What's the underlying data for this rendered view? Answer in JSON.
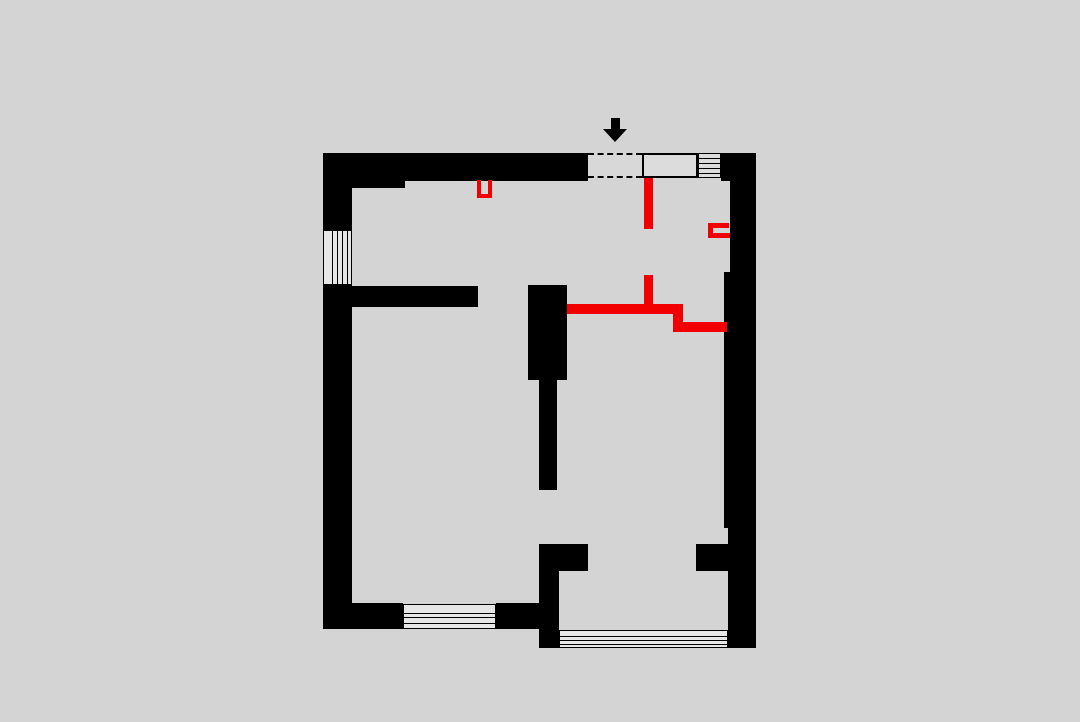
{
  "meta": {
    "description": "architectural floor plan drawing, black existing walls with red new partition walls, entry arrow at top",
    "canvas_w": 1080,
    "canvas_h": 722
  },
  "palette": {
    "bg": "#d4d4d4",
    "wall": "#000000",
    "new_wall": "#f20000",
    "fill_light": "#dcdcdc",
    "opening_fill": "#d8d8d8",
    "window_fill": "#e6e6e6"
  },
  "plan": {
    "shapes": [
      {
        "name": "top-wall-thick-left",
        "type": "wall",
        "x": 323,
        "y": 153,
        "w": 82,
        "h": 35
      },
      {
        "name": "top-wall",
        "type": "wall",
        "x": 405,
        "y": 153,
        "w": 183,
        "h": 28
      },
      {
        "name": "left-wall-upper",
        "type": "wall",
        "x": 323,
        "y": 153,
        "w": 29,
        "h": 77
      },
      {
        "name": "left-wall-lower",
        "type": "wall",
        "x": 323,
        "y": 285,
        "w": 29,
        "h": 344
      },
      {
        "name": "top-right-corner-wall",
        "type": "wall",
        "x": 721,
        "y": 153,
        "w": 35,
        "h": 28
      },
      {
        "name": "right-wall-upper",
        "type": "wall",
        "x": 730,
        "y": 181,
        "w": 26,
        "h": 91
      },
      {
        "name": "right-wall-mid",
        "type": "wall",
        "x": 724,
        "y": 272,
        "w": 32,
        "h": 256
      },
      {
        "name": "right-wall-lower",
        "type": "wall",
        "x": 728,
        "y": 528,
        "w": 28,
        "h": 120
      },
      {
        "name": "hallway-wall",
        "type": "wall",
        "x": 352,
        "y": 286,
        "w": 126,
        "h": 21
      },
      {
        "name": "center-column-upper",
        "type": "wall",
        "x": 528,
        "y": 285,
        "w": 39,
        "h": 95
      },
      {
        "name": "center-column-narrow",
        "type": "wall",
        "x": 539,
        "y": 380,
        "w": 18,
        "h": 110
      },
      {
        "name": "center-stub-wall",
        "type": "wall",
        "x": 539,
        "y": 544,
        "w": 49,
        "h": 27
      },
      {
        "name": "center-column-lower",
        "type": "wall",
        "x": 539,
        "y": 571,
        "w": 20,
        "h": 77
      },
      {
        "name": "right-stub-wall",
        "type": "wall",
        "x": 696,
        "y": 544,
        "w": 32,
        "h": 27
      },
      {
        "name": "bottom-wall-left-a",
        "type": "wall",
        "x": 352,
        "y": 603,
        "w": 51,
        "h": 26
      },
      {
        "name": "bottom-wall-left-b",
        "type": "wall",
        "x": 496,
        "y": 603,
        "w": 43,
        "h": 26
      },
      {
        "name": "window-left",
        "type": "window",
        "x": 323,
        "y": 230,
        "w": 29,
        "h": 55
      },
      {
        "name": "window-left-mullion-1",
        "type": "mullion",
        "x": 332,
        "y": 230,
        "w": 1,
        "h": 55
      },
      {
        "name": "window-left-mullion-2",
        "type": "mullion",
        "x": 337,
        "y": 230,
        "w": 1,
        "h": 55
      },
      {
        "name": "window-left-mullion-3",
        "type": "mullion",
        "x": 342,
        "y": 230,
        "w": 1,
        "h": 55
      },
      {
        "name": "window-left-mullion-4",
        "type": "mullion",
        "x": 347,
        "y": 230,
        "w": 1,
        "h": 55
      },
      {
        "name": "window-bottom-left",
        "type": "window",
        "x": 403,
        "y": 604,
        "w": 93,
        "h": 25
      },
      {
        "name": "window-bottom-left-mullion-1",
        "type": "mullion",
        "x": 404,
        "y": 613,
        "w": 91,
        "h": 1
      },
      {
        "name": "window-bottom-left-mullion-2",
        "type": "mullion",
        "x": 404,
        "y": 617,
        "w": 91,
        "h": 1
      },
      {
        "name": "window-bottom-left-mullion-3",
        "type": "mullion",
        "x": 404,
        "y": 623,
        "w": 91,
        "h": 1
      },
      {
        "name": "window-bottom-right",
        "type": "window",
        "x": 559,
        "y": 630,
        "w": 169,
        "h": 18
      },
      {
        "name": "window-bottom-right-mullion-1",
        "type": "mullion",
        "x": 560,
        "y": 636,
        "w": 167,
        "h": 1
      },
      {
        "name": "window-bottom-right-mullion-2",
        "type": "mullion",
        "x": 560,
        "y": 640,
        "w": 167,
        "h": 1
      },
      {
        "name": "window-bottom-right-mullion-3",
        "type": "mullion",
        "x": 560,
        "y": 644,
        "w": 167,
        "h": 1
      },
      {
        "name": "entry-door-opening",
        "type": "opening",
        "x": 588,
        "y": 153,
        "w": 54,
        "h": 25
      },
      {
        "name": "entry-cabinet",
        "type": "cabinet",
        "x": 642,
        "y": 153,
        "w": 56,
        "h": 25
      },
      {
        "name": "entry-hatch",
        "type": "hatch",
        "x": 698,
        "y": 153,
        "w": 23,
        "h": 25
      },
      {
        "name": "entry-hatch-line-1",
        "type": "mullion",
        "x": 698,
        "y": 158,
        "w": 23,
        "h": 1
      },
      {
        "name": "entry-hatch-line-2",
        "type": "mullion",
        "x": 698,
        "y": 163,
        "w": 23,
        "h": 1
      },
      {
        "name": "entry-hatch-line-3",
        "type": "mullion",
        "x": 698,
        "y": 168,
        "w": 23,
        "h": 1
      },
      {
        "name": "entry-hatch-line-4",
        "type": "mullion",
        "x": 698,
        "y": 173,
        "w": 23,
        "h": 1
      },
      {
        "name": "entry-arrow-shaft",
        "type": "arrow-shaft",
        "x": 611,
        "y": 118,
        "w": 9,
        "h": 11
      },
      {
        "name": "entry-arrow-head",
        "type": "arrow-head",
        "x": 603,
        "y": 129,
        "w": 24,
        "h": 13
      },
      {
        "name": "new-wall-u-left",
        "type": "new-wall",
        "x": 477,
        "y": 180,
        "w": 4,
        "h": 18
      },
      {
        "name": "new-wall-u-right",
        "type": "new-wall",
        "x": 488,
        "y": 180,
        "w": 4,
        "h": 18
      },
      {
        "name": "new-wall-u-bottom",
        "type": "new-wall",
        "x": 477,
        "y": 194,
        "w": 15,
        "h": 4
      },
      {
        "name": "new-wall-vertical-upper",
        "type": "new-wall",
        "x": 644,
        "y": 178,
        "w": 9,
        "h": 51
      },
      {
        "name": "new-wall-vertical-lower",
        "type": "new-wall",
        "x": 644,
        "y": 275,
        "w": 9,
        "h": 29
      },
      {
        "name": "new-wall-horizontal-main",
        "type": "new-wall",
        "x": 567,
        "y": 304,
        "w": 116,
        "h": 10
      },
      {
        "name": "new-wall-step",
        "type": "new-wall",
        "x": 673,
        "y": 314,
        "w": 10,
        "h": 8
      },
      {
        "name": "new-wall-horizontal-lower",
        "type": "new-wall",
        "x": 673,
        "y": 322,
        "w": 54,
        "h": 10
      },
      {
        "name": "new-wall-bracket-top",
        "type": "new-wall",
        "x": 708,
        "y": 223,
        "w": 21,
        "h": 5
      },
      {
        "name": "new-wall-bracket-left",
        "type": "new-wall",
        "x": 708,
        "y": 228,
        "w": 5,
        "h": 5
      },
      {
        "name": "new-wall-bracket-bottom",
        "type": "new-wall",
        "x": 708,
        "y": 233,
        "w": 22,
        "h": 5
      }
    ]
  }
}
